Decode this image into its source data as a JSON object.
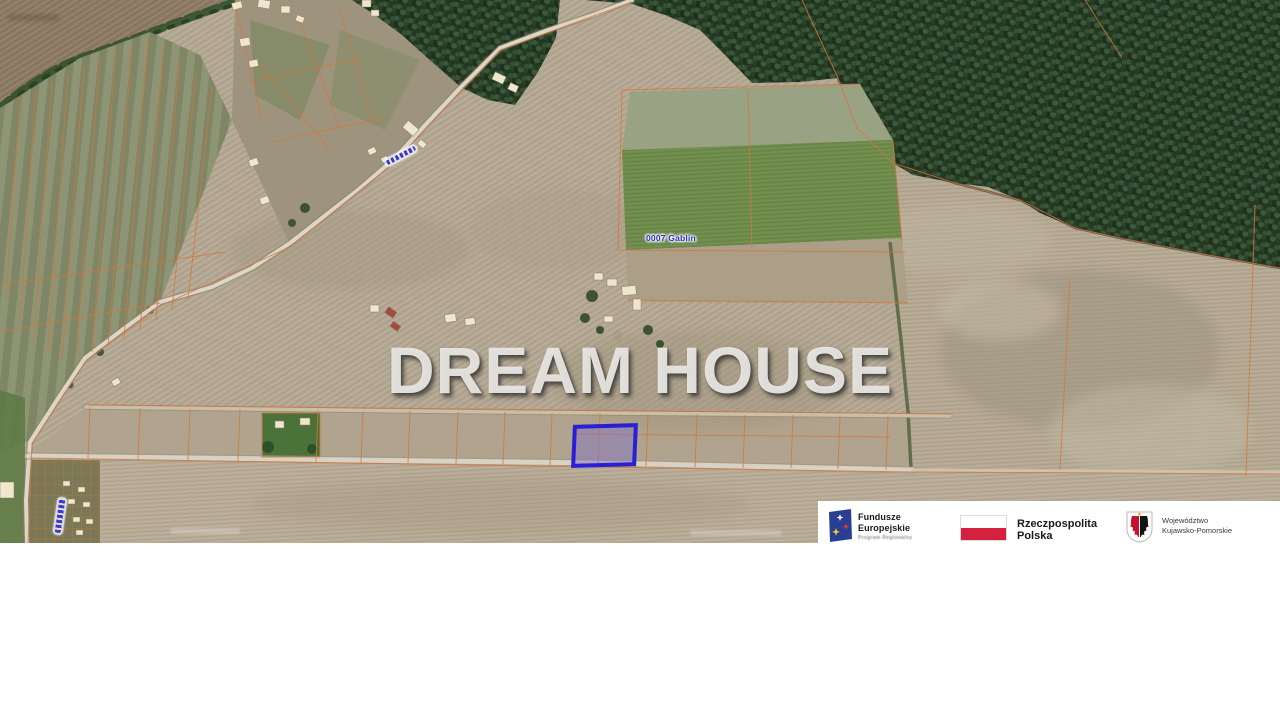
{
  "watermark": {
    "text": "DREAM HOUSE"
  },
  "map_labels": {
    "district": "0007 Gablin"
  },
  "colors": {
    "parcel_outline": "#2a1fd4",
    "parcel_fill": "rgba(130,115,190,0.5)",
    "cadastral_line": "#d3763e",
    "map_label_blue": "#2d2dd2",
    "poland_flag_red": "#d4213d",
    "eu_flag_navy": "#2a3f94"
  },
  "logo_bar": {
    "eu_funds": {
      "line1": "Fundusze",
      "line2": "Europejskie",
      "line3": "Program Regionalny"
    },
    "republic": {
      "line1": "Rzeczpospolita",
      "line2": "Polska"
    },
    "voivodeship": {
      "line1": "Województwo",
      "line2": "Kujawsko-Pomorskie"
    }
  }
}
